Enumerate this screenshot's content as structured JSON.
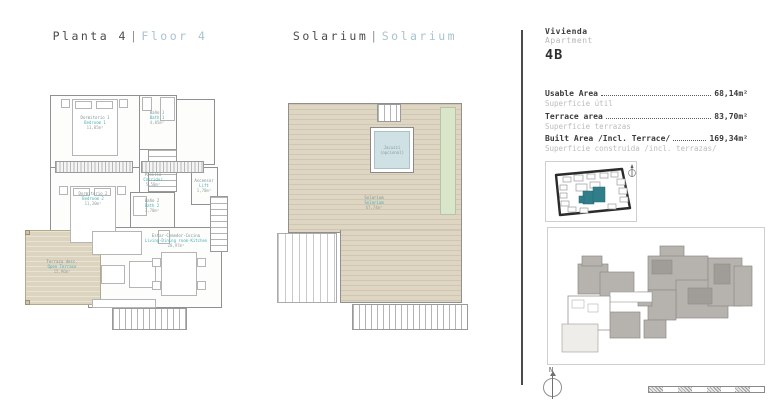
{
  "floor_panel": {
    "title": {
      "es": "Planta 4",
      "sep": "|",
      "en": "Floor 4"
    },
    "rooms": [
      {
        "es": "Dormitorio 1",
        "en": "Bedroom 1",
        "area": "11,05m²"
      },
      {
        "es": "Baño 1",
        "en": "Bath 1",
        "area": "4,05m²"
      },
      {
        "es": "Pasillo",
        "en": "Corridor",
        "area": "5,50m²"
      },
      {
        "es": "Ascensor",
        "en": "Lift",
        "area": "1,70m²"
      },
      {
        "es": "Dormitorio 2",
        "en": "Bedroom 2",
        "area": "11,30m²"
      },
      {
        "es": "Baño 2",
        "en": "Bath 2",
        "area": "3,70m²"
      },
      {
        "es": "Estar-Comedor-Cocina",
        "en": "Living-Dining room-Kitchen",
        "area": "28,97m²"
      },
      {
        "es": "Terraza desc.",
        "en": "Open Terrace",
        "area": "15,96m²"
      }
    ]
  },
  "solarium_panel": {
    "title": {
      "es": "Solarium",
      "sep": "|",
      "en": "Solarium"
    },
    "jacuzzi": {
      "line1": "Jacuzzi",
      "line2": "(opcional)"
    },
    "label": {
      "es": "Solarium",
      "en": "Solarium",
      "area": "67,74m²"
    }
  },
  "info_panel": {
    "vivienda": "Vivienda",
    "apartment": "Apartment",
    "unit": "4B",
    "areas": [
      {
        "en": "Usable Area",
        "es": "Superficie útil",
        "value": "68,14m²"
      },
      {
        "en": "Terrace area",
        "es": "Superficie terrazas",
        "value": "83,70m²"
      },
      {
        "en": "Built Area /Incl. Terrace/",
        "es": "Superficie construida /incl. terrazas/",
        "value": "169,34m²"
      }
    ],
    "north": "N"
  },
  "colors": {
    "accent_teal": "#45b0b4",
    "title_muted": "#a9c3ce",
    "terrace_beige": "#ddd4c0",
    "pool_blue": "#cfe1e5",
    "site_highlight": "#2f7e8a",
    "wall_gray": "#909090",
    "text_dark": "#3a3a3a",
    "text_light": "#b8b8b8"
  }
}
